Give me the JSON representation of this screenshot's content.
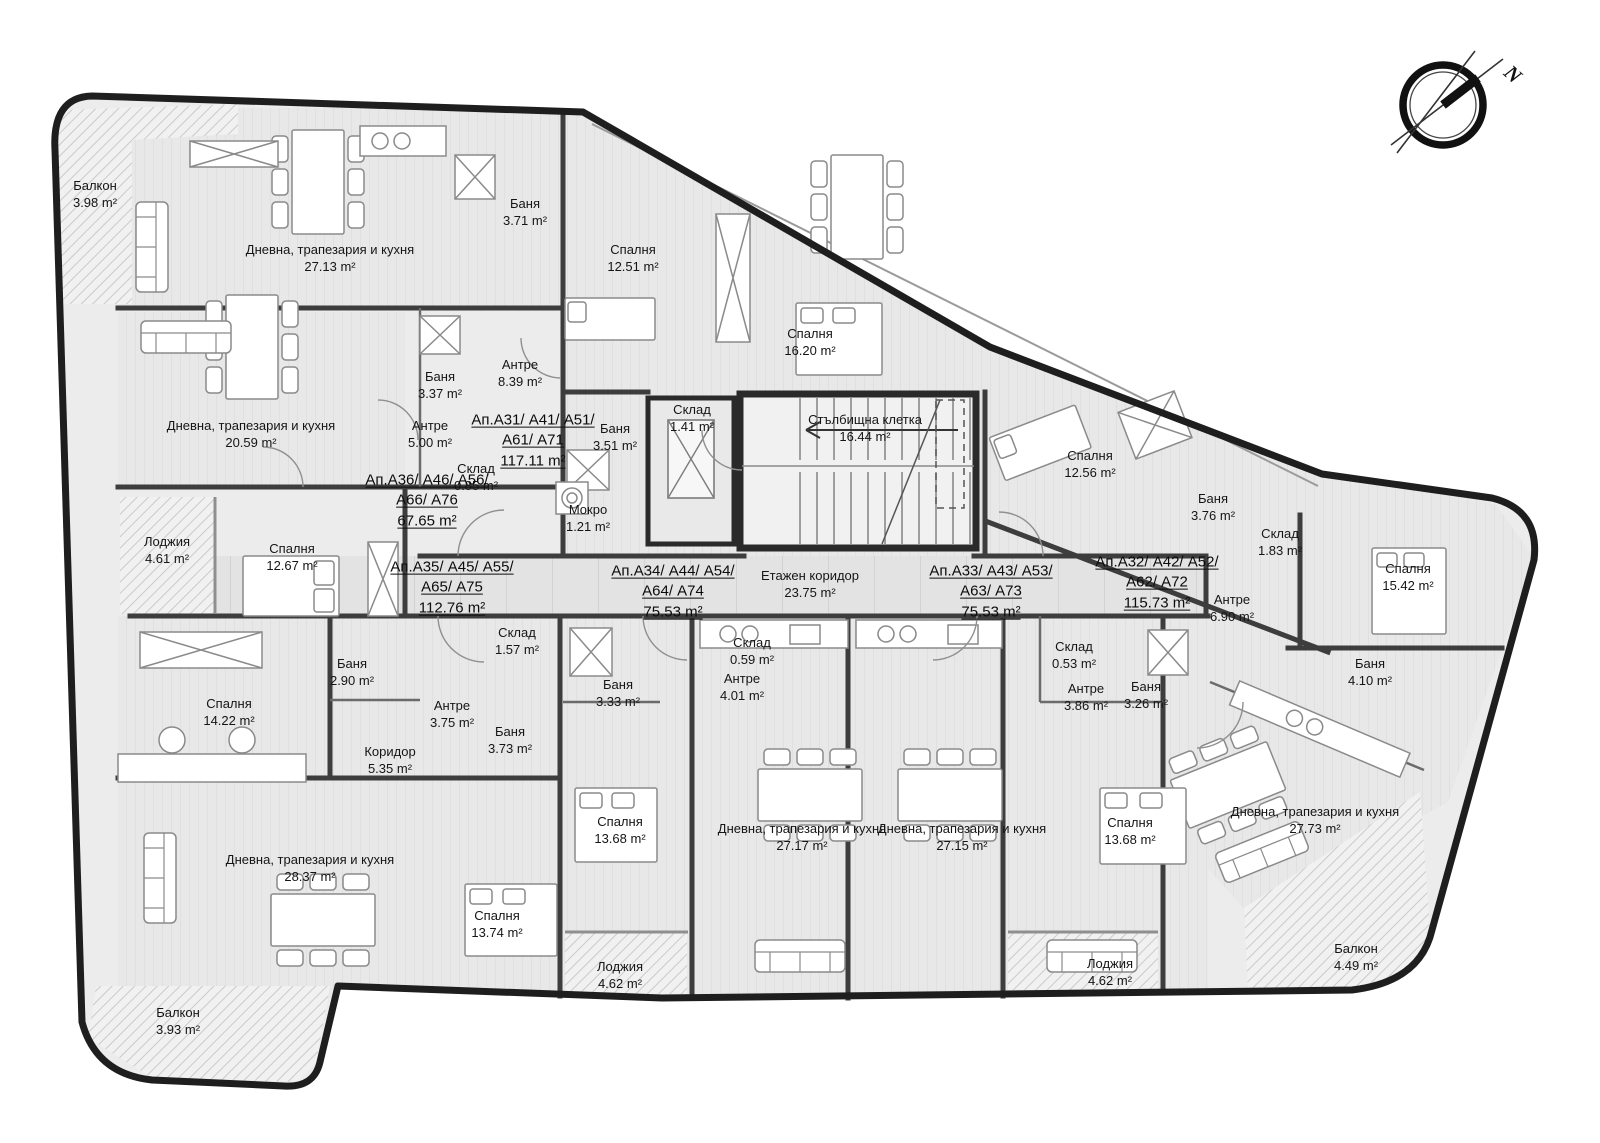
{
  "colors": {
    "wall": "#1e1e1e",
    "floor": "#ececec",
    "corridor_floor": "#e3e3e3",
    "hatch": "#c6c6c6",
    "text": "#111111",
    "background": "#ffffff"
  },
  "compass": {
    "label": "N"
  },
  "apartments": [
    {
      "line1": "Ап.А31/ А41/ А51/",
      "line2": "А61/ А71",
      "area": "117.11 m²"
    },
    {
      "line1": "Ап.А36/ А46/ А56/",
      "line2": "А66/ А76",
      "area": "67.65 m²"
    },
    {
      "line1": "Ап.А35/ А45/ А55/",
      "line2": "А65/ А75",
      "area": "112.76 m²"
    },
    {
      "line1": "Ап.А34/ А44/ А54/",
      "line2": "А64/ А74",
      "area": "75.53 m²"
    },
    {
      "line1": "Ап.А33/ А43/ А53/",
      "line2": "А63/ А73",
      "area": "75.53 m²"
    },
    {
      "line1": "Ап.А32/ А42/ А52/",
      "line2": "А62/ А72",
      "area": "115.73 m²"
    }
  ],
  "rooms": [
    {
      "name": "Балкон",
      "area": "3.98 m²"
    },
    {
      "name": "Дневна, трапезария и кухня",
      "area": "27.13 m²"
    },
    {
      "name": "Баня",
      "area": "3.71 m²"
    },
    {
      "name": "Спалня",
      "area": "12.51 m²"
    },
    {
      "name": "Спалня",
      "area": "16.20 m²"
    },
    {
      "name": "Баня",
      "area": "3.37 m²"
    },
    {
      "name": "Антре",
      "area": "8.39 m²"
    },
    {
      "name": "Дневна, трапезария и кухня",
      "area": "20.59 m²"
    },
    {
      "name": "Антре",
      "area": "5.00 m²"
    },
    {
      "name": "Баня",
      "area": "3.51 m²"
    },
    {
      "name": "Склад",
      "area": "1.41 m²"
    },
    {
      "name": "Стълбищна клетка",
      "area": "16.44 m²"
    },
    {
      "name": "Склад",
      "area": "0.85 m²"
    },
    {
      "name": "Мокро",
      "area": "1.21 m²"
    },
    {
      "name": "Лоджия",
      "area": "4.61 m²"
    },
    {
      "name": "Спалня",
      "area": "12.67 m²"
    },
    {
      "name": "Спалня",
      "area": "12.56 m²"
    },
    {
      "name": "Баня",
      "area": "3.76 m²"
    },
    {
      "name": "Склад",
      "area": "1.83 m²"
    },
    {
      "name": "Антре",
      "area": "6.90 m²"
    },
    {
      "name": "Спалня",
      "area": "15.42 m²"
    },
    {
      "name": "Баня",
      "area": "4.10 m²"
    },
    {
      "name": "Склад",
      "area": "1.57 m²"
    },
    {
      "name": "Баня",
      "area": "2.90 m²"
    },
    {
      "name": "Баня",
      "area": "3.33 m²"
    },
    {
      "name": "Склад",
      "area": "0.59 m²"
    },
    {
      "name": "Антре",
      "area": "4.01 m²"
    },
    {
      "name": "Антре",
      "area": "3.75 m²"
    },
    {
      "name": "Баня",
      "area": "3.73 m²"
    },
    {
      "name": "Спалня",
      "area": "14.22 m²"
    },
    {
      "name": "Коридор",
      "area": "5.35 m²"
    },
    {
      "name": "Склад",
      "area": "0.53 m²"
    },
    {
      "name": "Антре",
      "area": "3.86 m²"
    },
    {
      "name": "Баня",
      "area": "3.26 m²"
    },
    {
      "name": "Спалня",
      "area": "13.68 m²"
    },
    {
      "name": "Дневна, трапезария и кухня",
      "area": "27.17 m²"
    },
    {
      "name": "Дневна, трапезария и кухня",
      "area": "27.15 m²"
    },
    {
      "name": "Спалня",
      "area": "13.68 m²"
    },
    {
      "name": "Дневна, трапезария и кухня",
      "area": "27.73 m²"
    },
    {
      "name": "Дневна, трапезария и кухня",
      "area": "28.37 m²"
    },
    {
      "name": "Спалня",
      "area": "13.74 m²"
    },
    {
      "name": "Лоджия",
      "area": "4.62 m²"
    },
    {
      "name": "Лоджия",
      "area": "4.62 m²"
    },
    {
      "name": "Балкон",
      "area": "4.49 m²"
    },
    {
      "name": "Балкон",
      "area": "3.93 m²"
    },
    {
      "name": "Етажен коридор",
      "area": "23.75 m²"
    }
  ]
}
